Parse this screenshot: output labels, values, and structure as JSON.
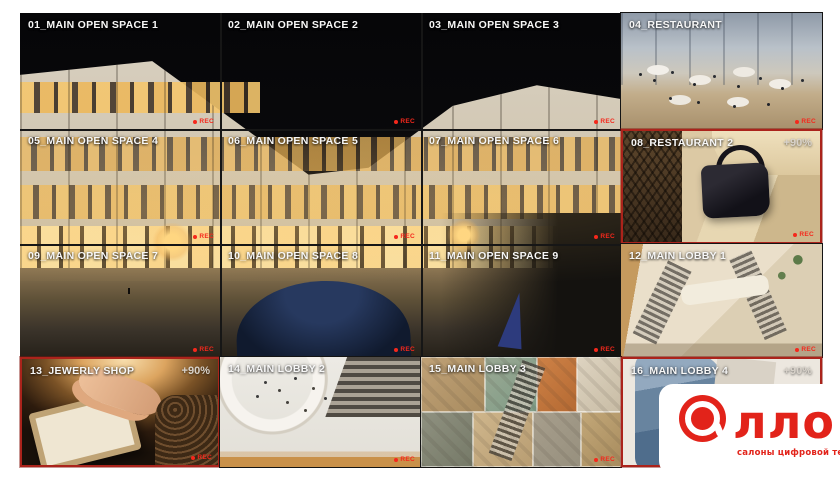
{
  "labels": {
    "rec": "REC"
  },
  "colors": {
    "frame_alert_red": "#ab231b",
    "rec_red": "#f5281c",
    "label_white": "#f7f7f7",
    "logo_red": "#e2231a",
    "canvas_white": "#ffffff"
  },
  "cells": [
    {
      "id": "01",
      "label": "01_MAIN OPEN SPACE 1"
    },
    {
      "id": "02",
      "label": "02_MAIN OPEN SPACE 2"
    },
    {
      "id": "03",
      "label": "03_MAIN OPEN SPACE 3"
    },
    {
      "id": "04",
      "label": "04_RESTAURANT"
    },
    {
      "id": "05",
      "label": "05_MAIN OPEN SPACE 4"
    },
    {
      "id": "06",
      "label": "06_MAIN OPEN SPACE 5"
    },
    {
      "id": "07",
      "label": "07_MAIN OPEN SPACE 6"
    },
    {
      "id": "08",
      "label": "08_RESTAURANT 2",
      "zoom": "+90%"
    },
    {
      "id": "09",
      "label": "09_MAIN OPEN SPACE 7"
    },
    {
      "id": "10",
      "label": "10_MAIN OPEN SPACE 8"
    },
    {
      "id": "11",
      "label": "11_MAIN OPEN SPACE 9"
    },
    {
      "id": "12",
      "label": "12_MAIN LOBBY 1"
    },
    {
      "id": "13",
      "label": "13_JEWERLY SHOP",
      "zoom": "+90%"
    },
    {
      "id": "14",
      "label": "14_MAIN LOBBY 2"
    },
    {
      "id": "15",
      "label": "15_MAIN LOBBY 3"
    },
    {
      "id": "16",
      "label": "16_MAIN LOBBY 4",
      "zoom": "+90%"
    }
  ],
  "logo": {
    "wordmark": "лло",
    "tagline": "салоны цифровой техники"
  }
}
